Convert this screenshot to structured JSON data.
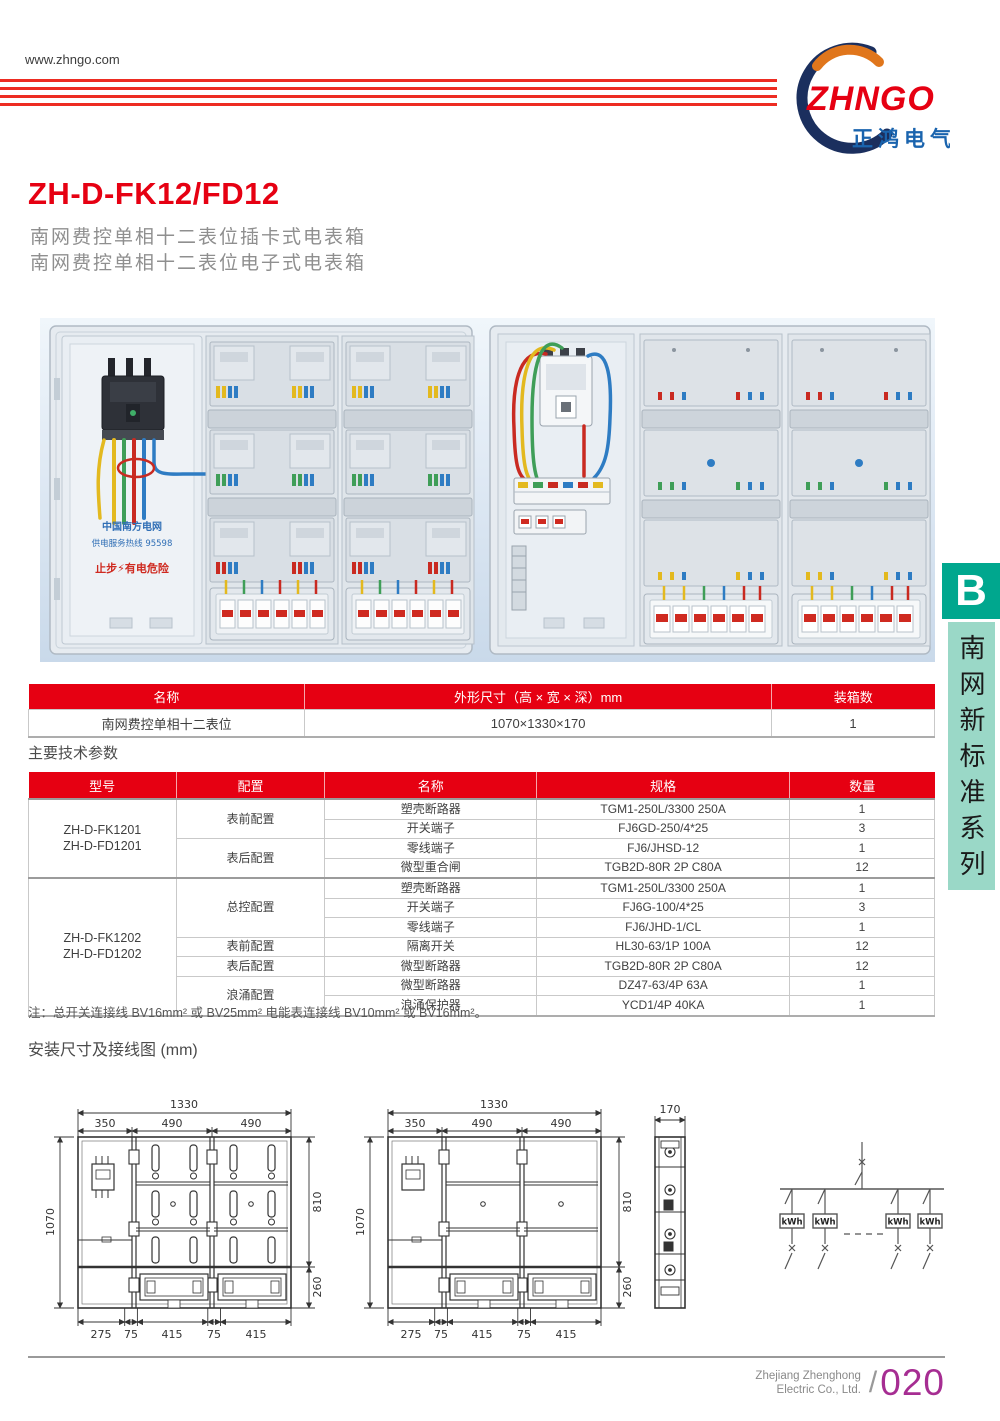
{
  "header": {
    "website": "www.zhngo.com",
    "logo_text": "ZHNGO",
    "logo_cn": "正鸿电气",
    "brand_red": "#e60012",
    "brand_navy": "#1b2f5e",
    "brand_orange": "#e0761c"
  },
  "product": {
    "model": "ZH-D-FK12/FD12",
    "subtitle1": "南网费控单相十二表位插卡式电表箱",
    "subtitle2": "南网费控单相十二表位电子式电表箱"
  },
  "photos": {
    "grid_label": "中国南方电网",
    "hotline_label": "供电服务热线 95598",
    "warning_label": "止步⚡有电危险"
  },
  "spec_table": {
    "headers": [
      "名称",
      "外形尺寸（高 × 宽 × 深）mm",
      "装箱数"
    ],
    "row": [
      "南网费控单相十二表位",
      "1070×1330×170",
      "1"
    ]
  },
  "section_params_title": "主要技术参数",
  "params_table": {
    "headers": [
      "型号",
      "配置",
      "名称",
      "规格",
      "数量"
    ],
    "groups": [
      {
        "model_lines": [
          "ZH-D-FK1201",
          "ZH-D-FD1201"
        ],
        "configs": [
          {
            "label": "表前配置",
            "rows": [
              [
                "塑壳断路器",
                "TGM1-250L/3300 250A",
                "1"
              ],
              [
                "开关端子",
                "FJ6GD-250/4*25",
                "3"
              ]
            ]
          },
          {
            "label": "表后配置",
            "rows": [
              [
                "零线端子",
                "FJ6/JHSD-12",
                "1"
              ],
              [
                "微型重合闸",
                "TGB2D-80R 2P C80A",
                "12"
              ]
            ]
          }
        ]
      },
      {
        "model_lines": [
          "ZH-D-FK1202",
          "ZH-D-FD1202"
        ],
        "configs": [
          {
            "label": "总控配置",
            "rows": [
              [
                "塑壳断路器",
                "TGM1-250L/3300 250A",
                "1"
              ],
              [
                "开关端子",
                "FJ6G-100/4*25",
                "3"
              ],
              [
                "零线端子",
                "FJ6/JHD-1/CL",
                "1"
              ]
            ]
          },
          {
            "label": "表前配置",
            "rows": [
              [
                "隔离开关",
                "HL30-63/1P 100A",
                "12"
              ]
            ]
          },
          {
            "label": "表后配置",
            "rows": [
              [
                "微型断路器",
                "TGB2D-80R 2P C80A",
                "12"
              ]
            ]
          },
          {
            "label": "浪涌配置",
            "rows": [
              [
                "微型断路器",
                "DZ47-63/4P 63A",
                "1"
              ],
              [
                "浪涌保护器",
                "YCD1/4P 40KA",
                "1"
              ]
            ]
          }
        ]
      }
    ]
  },
  "note": "注：总开关连接线 BV16mm² 或 BV25mm² 电能表连接线 BV10mm² 或 BV16mm²。",
  "section_install_title": "安装尺寸及接线图 (mm)",
  "diagrams": {
    "dims": {
      "w1330": "1330",
      "w350": "350",
      "w490": "490",
      "h1070": "1070",
      "h810": "810",
      "h260": "260",
      "b275": "275",
      "b75": "75",
      "b415": "415",
      "d170": "170"
    },
    "kwh_label": "kWh"
  },
  "side_banner": {
    "letter": "B",
    "series": "南网新标准系列",
    "badge_color": "#00a78e",
    "banner_color": "#9ad8c7"
  },
  "footer": {
    "company_line1": "Zhejiang Zhenghong",
    "company_line2": "Electric Co., Ltd.",
    "separator": "/",
    "page": "020",
    "page_color": "#a62d92"
  }
}
